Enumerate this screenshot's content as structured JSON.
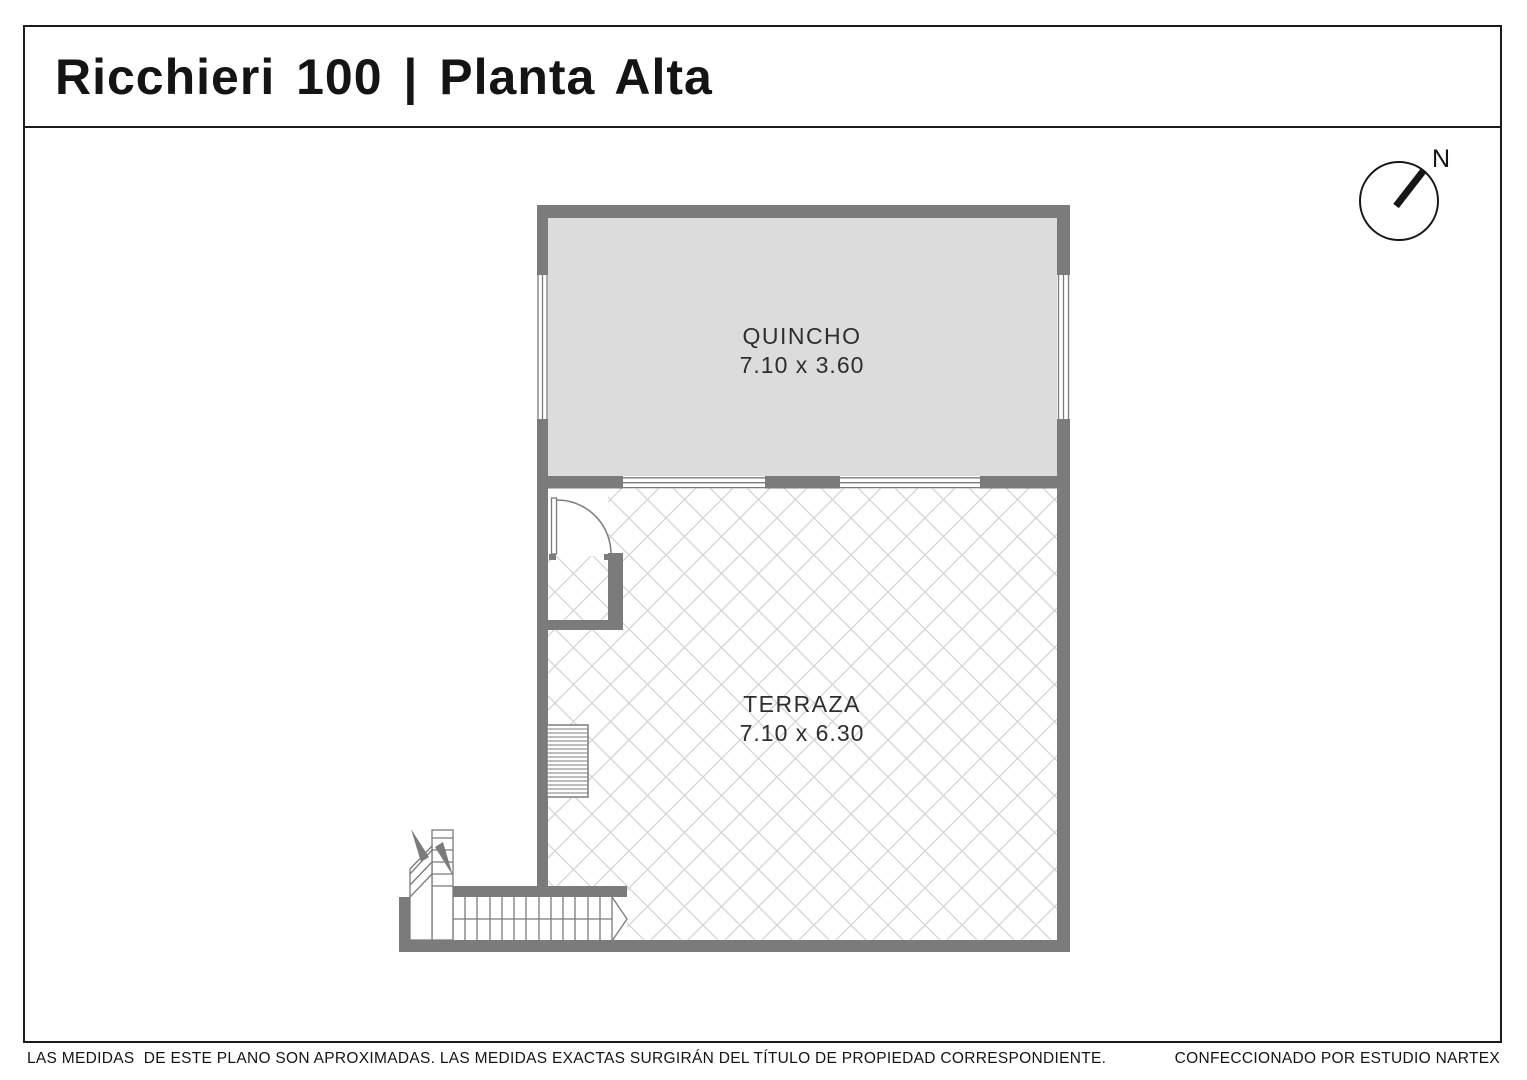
{
  "header": {
    "title": "Ricchieri 100 | Planta Alta"
  },
  "compass": {
    "label": "N"
  },
  "rooms": [
    {
      "name": "QUINCHO",
      "dimensions": "7.10 x 3.60"
    },
    {
      "name": "TERRAZA",
      "dimensions": "7.10 x 6.30"
    }
  ],
  "footer": {
    "disclaimer": "LAS MEDIDAS  DE ESTE PLANO SON APROXIMADAS. LAS MEDIDAS EXACTAS SURGIRÁN DEL TÍTULO DE PROPIEDAD CORRESPONDIENTE.",
    "credit": "CONFECCIONADO POR ESTUDIO NARTEX"
  },
  "colors": {
    "wall": "#7b7b7b",
    "room_fill": "#dcdcdc",
    "lattice_line": "#d4d4d4",
    "line": "#1b1b1b"
  }
}
